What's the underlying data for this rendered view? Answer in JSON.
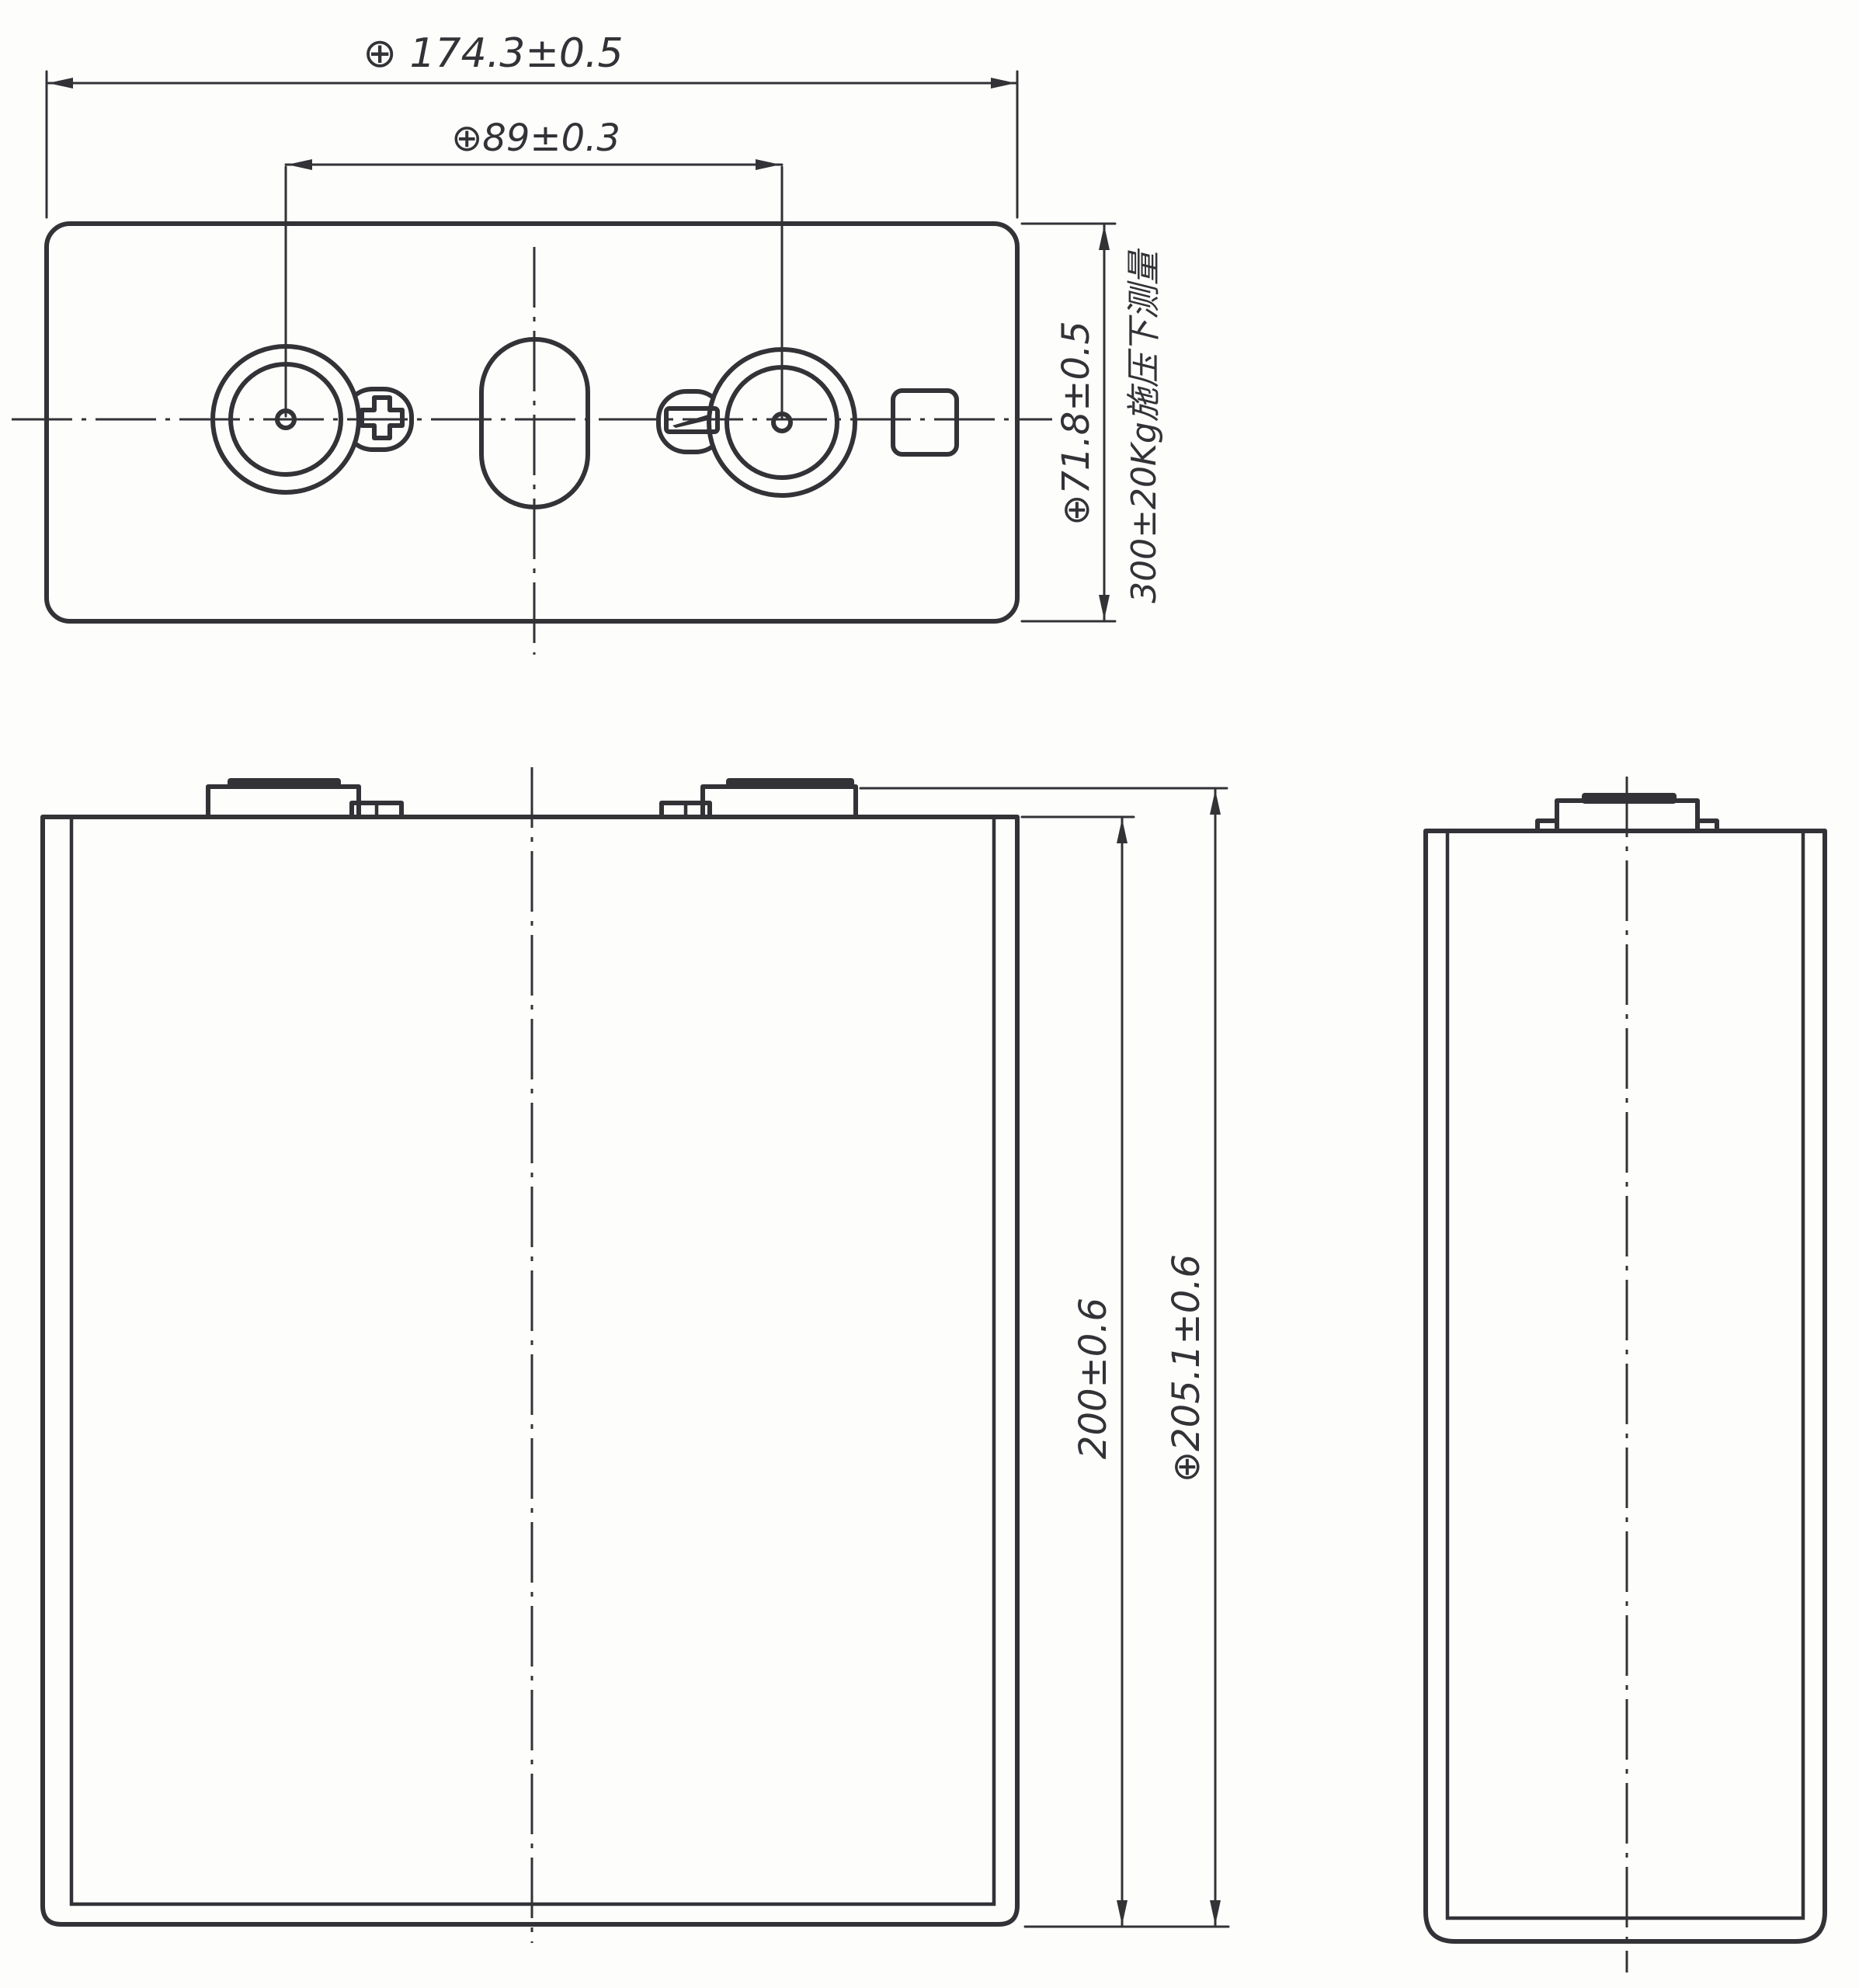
{
  "drawing": {
    "kind": "prismatic-battery-cell-engineering-drawing",
    "views": {
      "top_view": "top view with positive terminal, vent and negative terminal",
      "front_view": "front view of cell body with two terminals",
      "side_view": "side view of cell body with one terminal"
    }
  },
  "dims": {
    "width": "⊕ 174.3±0.5",
    "pitch": "⊕89±0.3",
    "thickness": "⊕71.8±0.5",
    "thickness_note": "300±20Kg施压下测量",
    "height_body": "200±0.6",
    "height_total": "⊕205.1±0.6"
  },
  "symbols": {
    "position_tolerance": "⊕",
    "positive_terminal_marker": "plus-cross",
    "negative_terminal_marker": "slanted-bar"
  },
  "colors": {
    "line": "#323237",
    "background": "#fdfdfb"
  }
}
